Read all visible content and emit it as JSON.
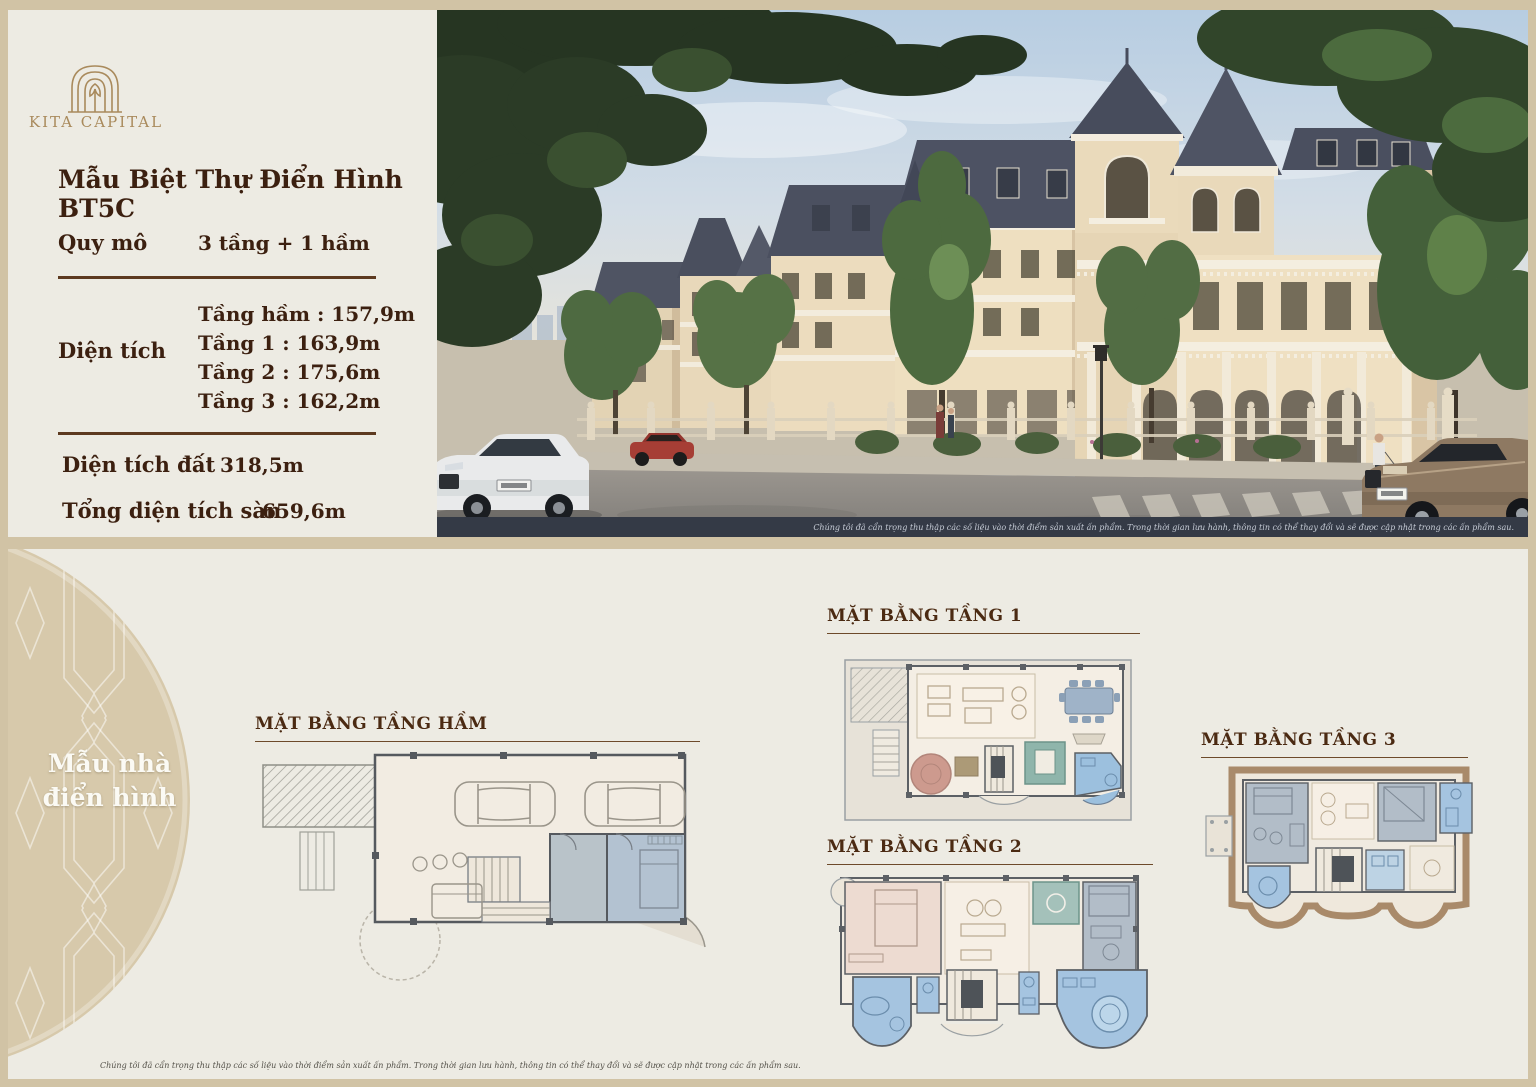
{
  "brand": {
    "name": "KITA CAPITAL",
    "logo_icon": "arch-gate-icon"
  },
  "info_panel": {
    "title": "Mẫu Biệt Thự Điển Hình BT5C",
    "quy_mo": {
      "label": "Quy mô",
      "value": "3 tầng + 1 hầm"
    },
    "dien_tich": {
      "label": "Diện tích",
      "lines": [
        "Tầng hầm : 157,9m",
        "Tầng 1 : 163,9m",
        "Tầng 2 : 175,6m",
        "Tầng 3 : 162,2m"
      ]
    },
    "dien_tich_dat": {
      "label": "Diện tích đất",
      "value": "318,5m"
    },
    "tong_dien_tich_san": {
      "label": "Tổng diện tích sàn",
      "value": "659,6m"
    }
  },
  "photo": {
    "description": "Street perspective rendering of French neoclassical villas with slate mansard roofs and turrets",
    "disclaimer": "Chúng tôi đã cẩn trọng thu thập các số liệu vào thời điểm sản xuất ấn phẩm. Trong thời gian lưu hành, thông tin có thể thay đổi và sẽ được cập nhật trong các ấn phẩm sau."
  },
  "badge": {
    "line1": "Mẫu nhà",
    "line2": "điển hình"
  },
  "plans": {
    "basement": {
      "title": "MẶT BẰNG TẦNG HẦM"
    },
    "floor1": {
      "title": "MẶT BẰNG TẦNG 1"
    },
    "floor2": {
      "title": "MẶT BẰNG TẦNG 2"
    },
    "floor3": {
      "title": "MẶT BẰNG TẦNG 3"
    }
  },
  "footer": {
    "disclaimer": "Chúng tôi đã cẩn trọng thu thập các số liệu vào thời điểm sản xuất ấn phẩm. Trong thời gian lưu hành, thông tin có thể thay đổi và sẽ được cập nhật trong các ấn phẩm sau."
  },
  "colors": {
    "frame_tan": "#d1c3a5",
    "panel_cream": "#edebe3",
    "title_maroon": "#3c2010",
    "gold": "#a98a5c",
    "divider_brown": "#5d3a20",
    "circle_tan": "#d7c9ab",
    "plan_blue": "#a5c4e0",
    "plan_grayblue": "#b2bdc8",
    "plan_pink": "#eddbd1",
    "plan_teal": "#a4c1ba",
    "plan_brown": "#a98a6a",
    "roof_slate": "#4d5263"
  }
}
